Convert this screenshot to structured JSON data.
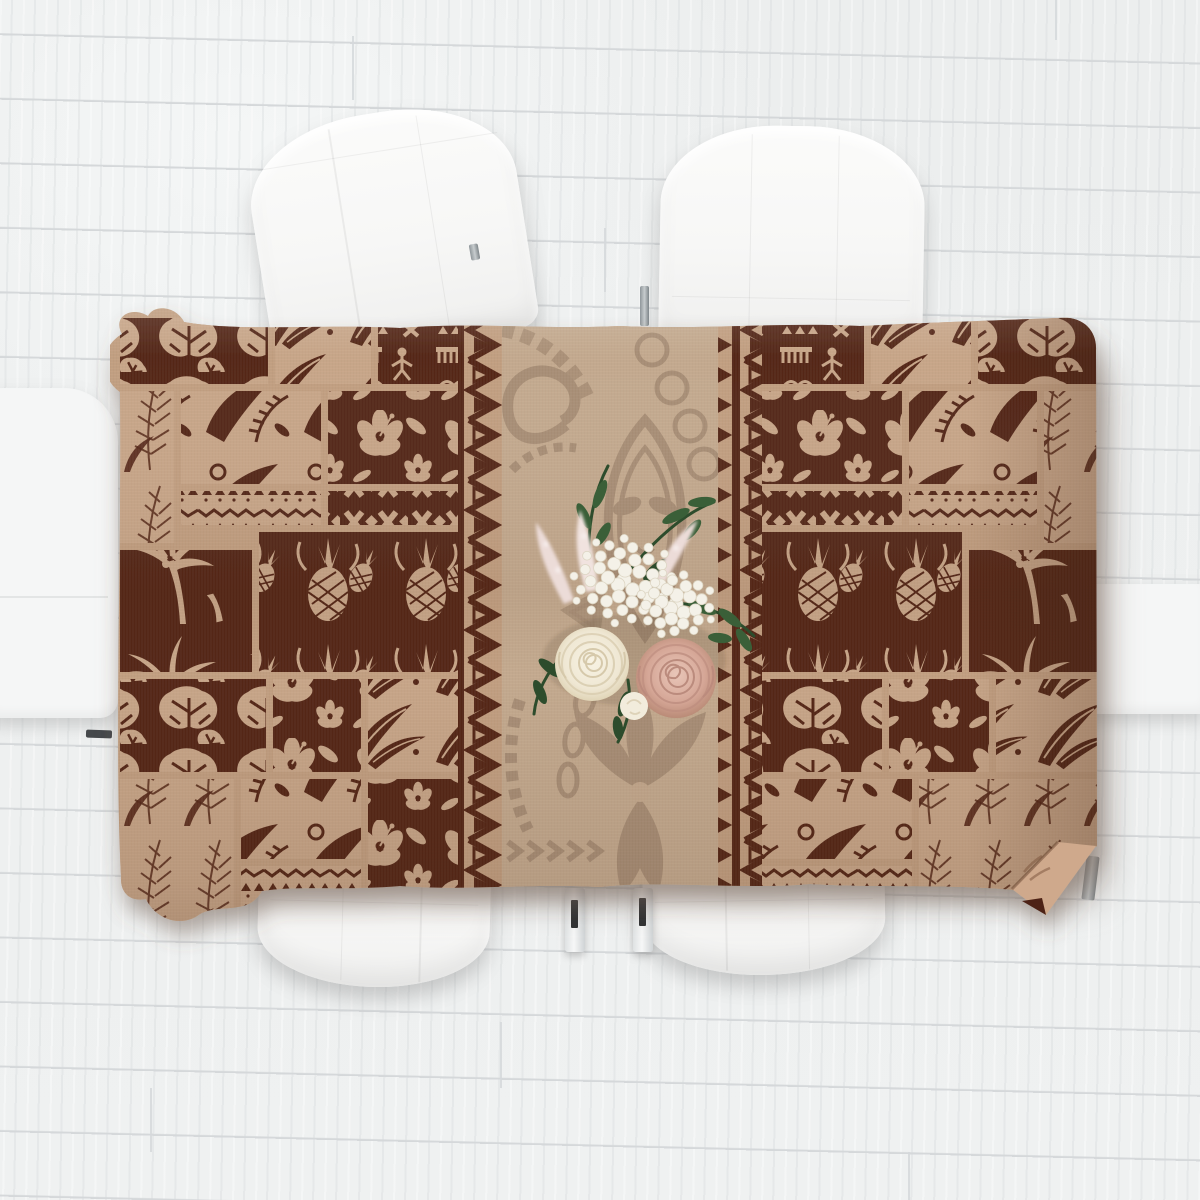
{
  "objects": {
    "floor": "whitewashed wood plank floor",
    "tablecloth": "polynesian tapa patchwork tablecloth",
    "chair_back_top_left": "white dining chair back",
    "chair_back_top_right": "white dining chair back",
    "seat_bottom_left": "white dining chair seat",
    "seat_bottom_right": "white dining chair seat",
    "side_furniture_left": "white chair at left edge",
    "side_furniture_right": "white chair at right edge",
    "bouquet": "white and blush rose bouquet with greenery"
  },
  "colors": {
    "floor-base": "#edefef",
    "plank-seam": "#d5d8da",
    "furniture-white": "#f5f6f6",
    "handle-dark": "#45484b",
    "cloth-dark": "#542718",
    "cloth-light": "#c8a689",
    "cloth-gutter": "#c29f81",
    "center-bg": "#c4aa8f",
    "motif-taupe": "#8e7660",
    "underside-tan": "#cfa98c",
    "fold-dark": "#4e2416",
    "leaf-green": "#3a5f38",
    "leaf-dark": "#2d4c2c",
    "hydrangea-white": "#f4f1e8",
    "hydrangea-line": "#ddd6c4",
    "astilbe-pink": "#ecdcd8",
    "rose-cream": "#efe7d3",
    "rose-cream-line": "#d6c9ab",
    "rose-pink": "#d5a696",
    "rose-pink-line": "#bb8b7d",
    "bud-white": "#f2ecdc"
  },
  "tablecloth": {
    "bounds": {
      "x": 118,
      "y": 315,
      "w": 980,
      "h": 615
    },
    "center_panel": {
      "x": 502,
      "y": 315,
      "w": 216,
      "h": 615
    },
    "zigzag_columns": [
      {
        "x": 458,
        "y": 315,
        "w": 44,
        "h": 615
      },
      {
        "x": 718,
        "y": 315,
        "w": 44,
        "h": 615
      }
    ],
    "patches": [
      {
        "x": 120,
        "y": 318,
        "w": 148,
        "h": 66,
        "t": "monstera"
      },
      {
        "x": 275,
        "y": 318,
        "w": 96,
        "h": 66,
        "t": "feathers"
      },
      {
        "x": 378,
        "y": 318,
        "w": 80,
        "h": 66,
        "t": "tapa"
      },
      {
        "x": 120,
        "y": 391,
        "w": 54,
        "h": 152,
        "t": "fronds"
      },
      {
        "x": 181,
        "y": 391,
        "w": 140,
        "h": 93,
        "t": "jungle"
      },
      {
        "x": 328,
        "y": 391,
        "w": 130,
        "h": 93,
        "t": "hibiscus"
      },
      {
        "x": 181,
        "y": 491,
        "w": 140,
        "h": 34,
        "t": "geo"
      },
      {
        "x": 328,
        "y": 491,
        "w": 130,
        "h": 34,
        "t": "xband"
      },
      {
        "x": 120,
        "y": 550,
        "w": 132,
        "h": 122,
        "t": "palms"
      },
      {
        "x": 259,
        "y": 532,
        "w": 199,
        "h": 140,
        "t": "pineapple"
      },
      {
        "x": 120,
        "y": 679,
        "w": 146,
        "h": 93,
        "t": "monstera"
      },
      {
        "x": 273,
        "y": 679,
        "w": 88,
        "h": 93,
        "t": "hibiscus"
      },
      {
        "x": 368,
        "y": 679,
        "w": 90,
        "h": 93,
        "t": "feathers"
      },
      {
        "x": 120,
        "y": 779,
        "w": 114,
        "h": 151,
        "t": "fronds"
      },
      {
        "x": 241,
        "y": 779,
        "w": 120,
        "h": 80,
        "t": "jungle"
      },
      {
        "x": 241,
        "y": 866,
        "w": 120,
        "h": 64,
        "t": "geo"
      },
      {
        "x": 368,
        "y": 779,
        "w": 90,
        "h": 151,
        "t": "hibiscus"
      },
      {
        "x": 762,
        "y": 318,
        "w": 102,
        "h": 66,
        "t": "tapa"
      },
      {
        "x": 871,
        "y": 318,
        "w": 100,
        "h": 66,
        "t": "feathers"
      },
      {
        "x": 978,
        "y": 318,
        "w": 120,
        "h": 66,
        "t": "monstera"
      },
      {
        "x": 762,
        "y": 391,
        "w": 140,
        "h": 93,
        "t": "hibiscus"
      },
      {
        "x": 909,
        "y": 391,
        "w": 128,
        "h": 93,
        "t": "jungle"
      },
      {
        "x": 1044,
        "y": 391,
        "w": 54,
        "h": 152,
        "t": "fronds"
      },
      {
        "x": 762,
        "y": 491,
        "w": 140,
        "h": 34,
        "t": "xband"
      },
      {
        "x": 909,
        "y": 491,
        "w": 128,
        "h": 34,
        "t": "geo"
      },
      {
        "x": 762,
        "y": 532,
        "w": 200,
        "h": 140,
        "t": "pineapple"
      },
      {
        "x": 969,
        "y": 550,
        "w": 129,
        "h": 122,
        "t": "palms"
      },
      {
        "x": 762,
        "y": 679,
        "w": 120,
        "h": 93,
        "t": "monstera"
      },
      {
        "x": 889,
        "y": 679,
        "w": 100,
        "h": 93,
        "t": "hibiscus"
      },
      {
        "x": 996,
        "y": 679,
        "w": 102,
        "h": 93,
        "t": "feathers"
      },
      {
        "x": 762,
        "y": 779,
        "w": 150,
        "h": 80,
        "t": "jungle"
      },
      {
        "x": 762,
        "y": 866,
        "w": 150,
        "h": 64,
        "t": "geo"
      },
      {
        "x": 919,
        "y": 779,
        "w": 179,
        "h": 151,
        "t": "fronds"
      }
    ]
  },
  "bouquet": {
    "hydrangea_clusters": [
      {
        "id": "hyd-1",
        "cx": 118,
        "cy": 128,
        "r": 54,
        "n": 44
      },
      {
        "id": "hyd-2",
        "cx": 170,
        "cy": 152,
        "r": 40,
        "n": 30
      }
    ],
    "flowers": [
      "white hydrangea",
      "cream rose",
      "blush pink rose",
      "white rosebud",
      "pink astilbe",
      "green foliage"
    ]
  }
}
